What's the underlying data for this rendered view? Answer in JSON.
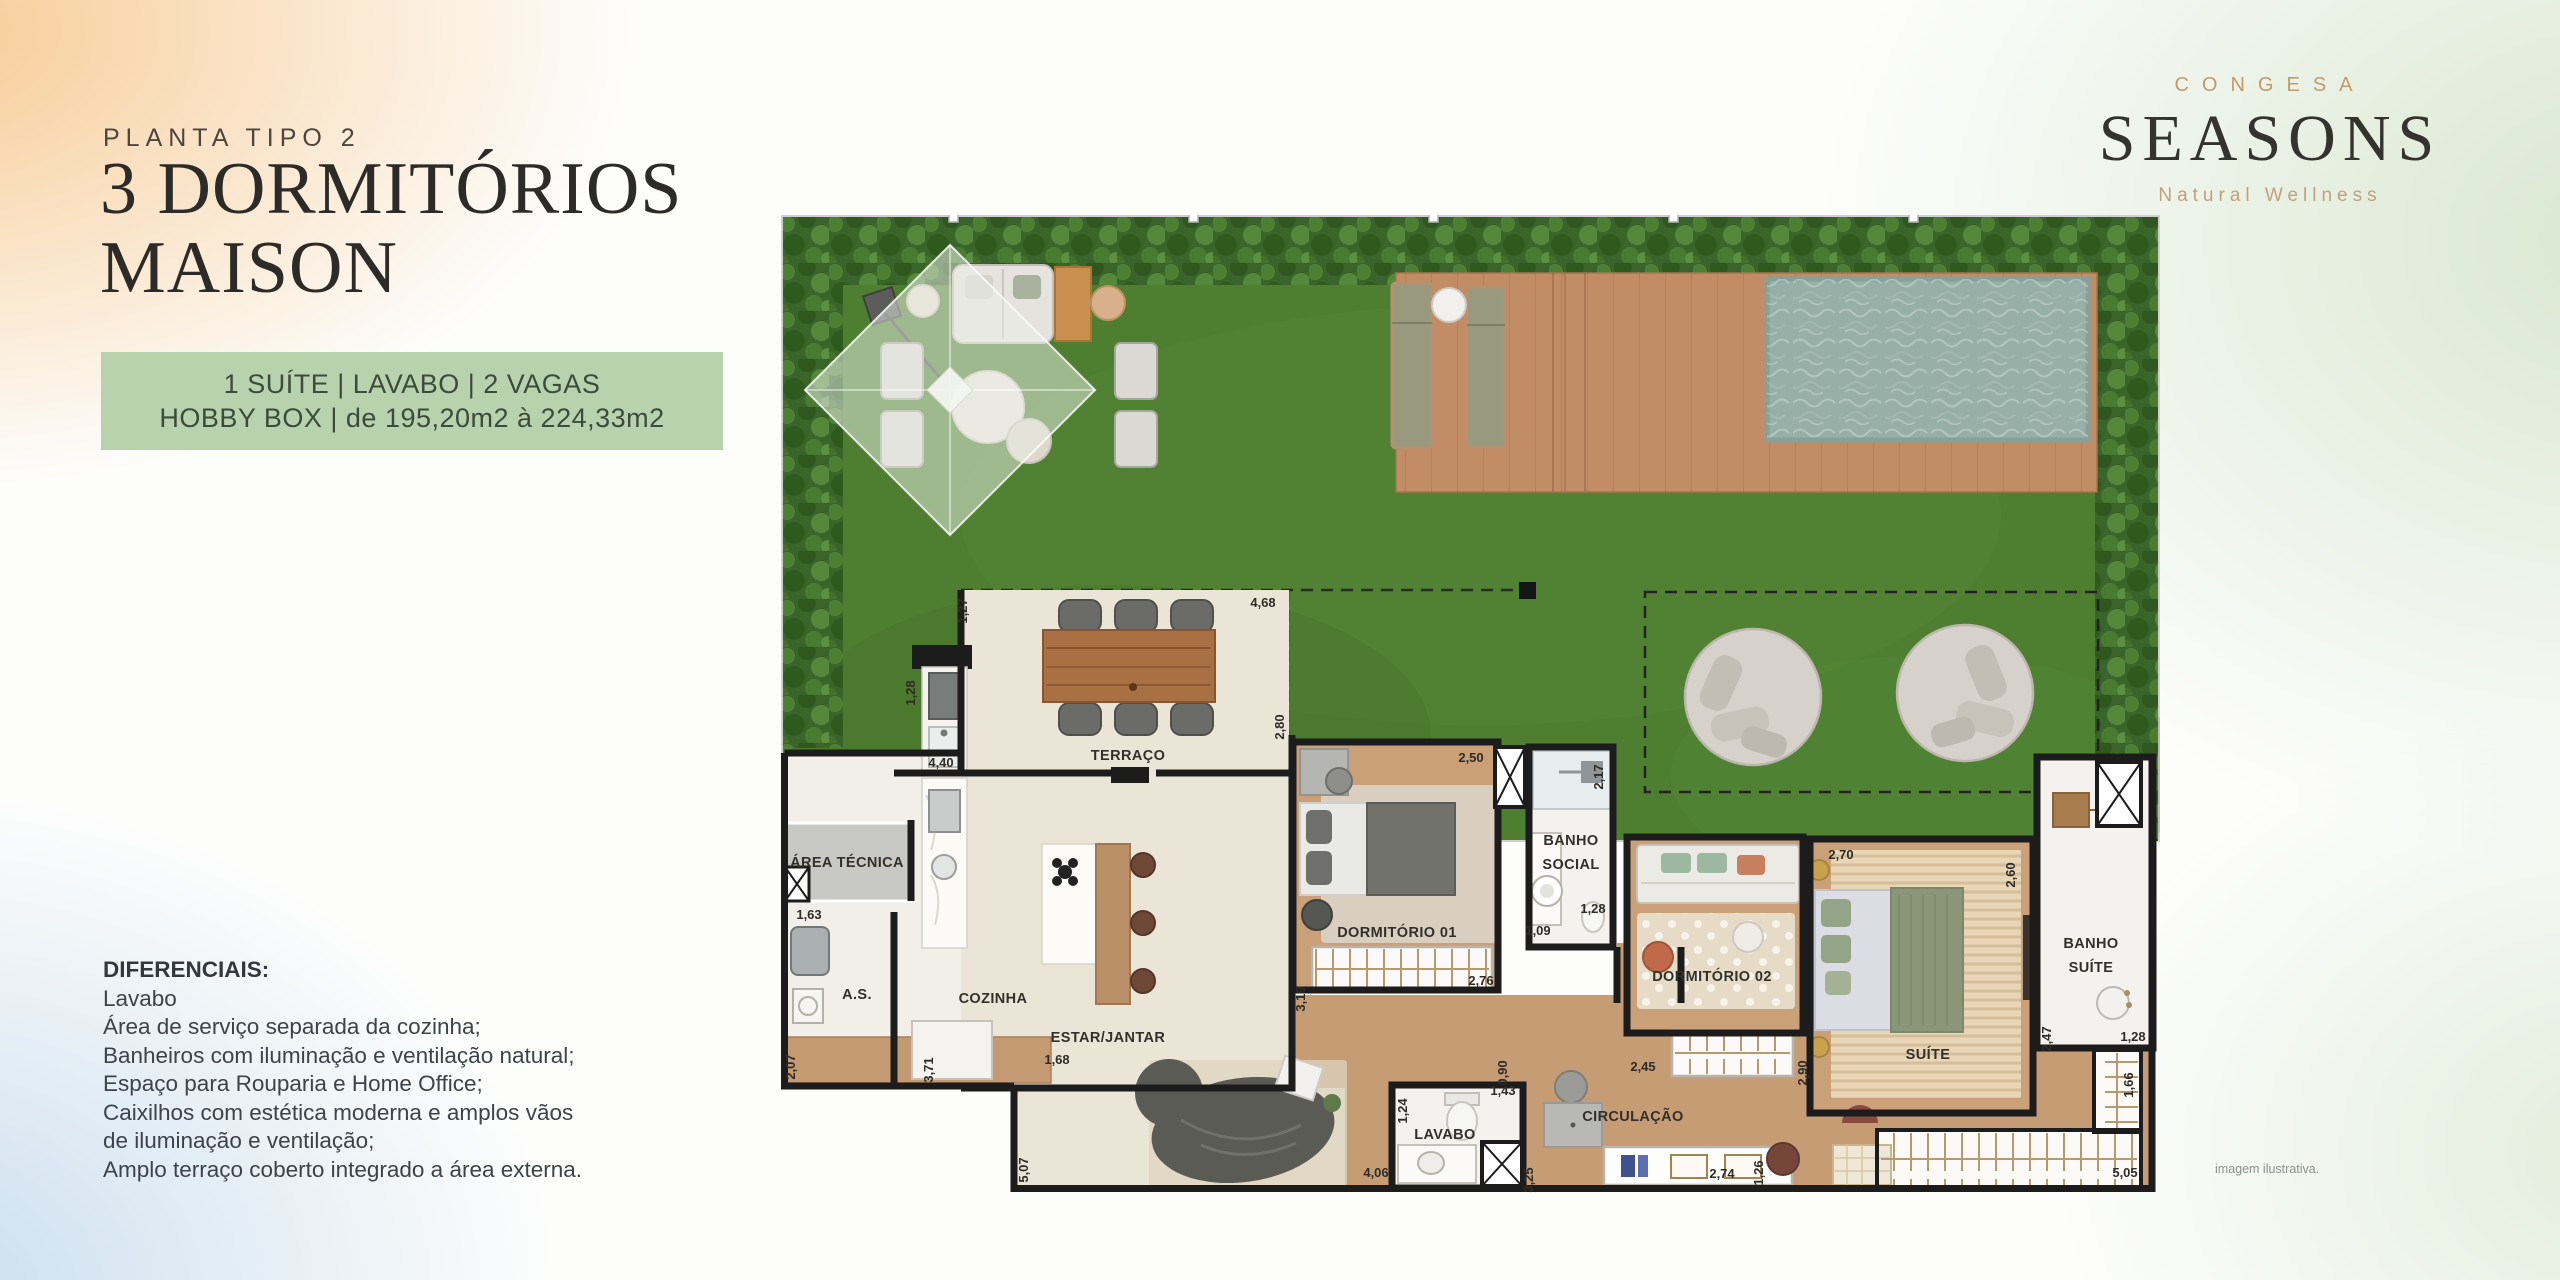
{
  "page": {
    "planta_label": "PLANTA TIPO 2",
    "title_line1": "3 DORMITÓRIOS",
    "title_line2": "MAISON",
    "disclaimer": "imagem ilustrativa."
  },
  "badge": {
    "line1": "1 SUÍTE | LAVABO | 2 VAGAS",
    "line2": "HOBBY BOX | de 195,20m2 à 224,33m2"
  },
  "diferenciais": {
    "title": "DIFERENCIAIS:",
    "items": [
      "Lavabo",
      "Área de serviço separada da cozinha;",
      "Banheiros com iluminação e ventilação natural;",
      "Espaço para Rouparia e Home Office;",
      "Caixilhos com estética moderna e amplos vãos de iluminação e ventilação;",
      "Amplo terraço coberto integrado a área externa."
    ]
  },
  "logo": {
    "brand": "CONGESA",
    "name": "SEASONS",
    "tagline": "Natural Wellness"
  },
  "plan": {
    "rooms": {
      "terraco": "TERRAÇO",
      "area_tecnica": "ÁREA TÉCNICA",
      "as_label": "A.S.",
      "cozinha": "COZINHA",
      "estar": "ESTAR/JANTAR",
      "dorm1": "DORMITÓRIO 01",
      "banho_social_l1": "BANHO",
      "banho_social_l2": "SOCIAL",
      "lavabo": "LAVABO",
      "circulacao": "CIRCULAÇÃO",
      "dorm2": "DORMITÓRIO 02",
      "suite": "SUÍTE",
      "banho_suite_l1": "BANHO",
      "banho_suite_l2": "SUÍTE"
    },
    "dims": {
      "terraco_left": "1,27",
      "terraco_top": "4,68",
      "terraco_right": "2,80",
      "grill_counter": "1,28",
      "terraco_w": "4,40",
      "as_top": "1,63",
      "as_left": "2,07",
      "cozinha_v": "3,71",
      "cozinha_bottom": "1,68",
      "estar_left": "5,07",
      "estar_bottom": "4,06",
      "dorm1_top": "2,50",
      "dorm1_left": "3,19",
      "dorm1_bottom": "2,76",
      "banho_social_right": "2,17",
      "banho_social_w": "1,28",
      "banho_social_door": "1,09",
      "lavabo_shaft": "0,90",
      "lavabo_left": "1,24",
      "lavabo_top": "1,43",
      "circ_left": "3,25",
      "circ_shelf": "2,74",
      "circ_right": "1,26",
      "dorm2_bottom": "2,45",
      "dorm2_closet": "2,90",
      "suite_top": "2,70",
      "suite_right": "2,60",
      "banho_suite_left": "2,47",
      "banho_suite_bottom": "1,28",
      "rouparia_right": "1,66",
      "rouparia_bottom": "5,05"
    }
  },
  "colors": {
    "badge_bg": "#b9d2ae",
    "badge_text": "#3c4b3a",
    "brand_gold": "#c49a6a",
    "logo_dark": "#34332e",
    "lawn_green": "#4e7f31",
    "hedge_green": "#3a652a",
    "deck_wood": "#c28c66",
    "pool_water": "#98afa8",
    "wall_black": "#1c1c1c",
    "floor_beige": "#ebe5d8",
    "floor_wood": "#c59c74"
  }
}
